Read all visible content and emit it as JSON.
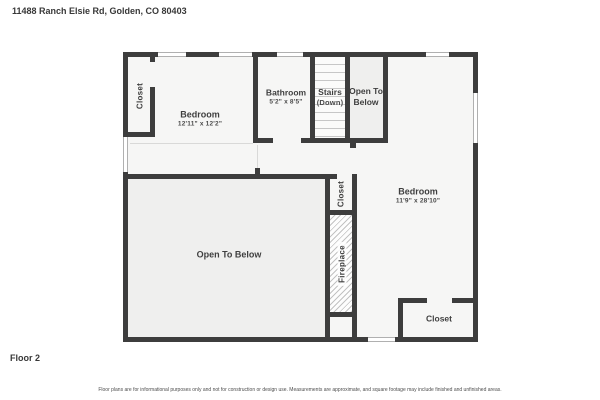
{
  "header": {
    "title": "11488 Ranch Elsie Rd, Golden, CO 80403"
  },
  "plan": {
    "rooms": {
      "closet_upper_left": {
        "label": "Closet"
      },
      "bedroom_upper": {
        "label": "Bedroom",
        "dimensions": "12'11\" x 12'2\""
      },
      "bathroom": {
        "label": "Bathroom",
        "dimensions": "5'2\" x 8'5\""
      },
      "stairs": {
        "label": "Stairs",
        "sublabel": "(Down)"
      },
      "open_to_below_upper": {
        "label": "Open To Below"
      },
      "bedroom_right": {
        "label": "Bedroom",
        "dimensions": "11'9\" x 28'10\""
      },
      "open_to_below_main": {
        "label": "Open To Below"
      },
      "closet_middle": {
        "label": "Closet"
      },
      "fireplace": {
        "label": "Fireplace"
      },
      "closet_bottom_right": {
        "label": "Closet"
      }
    }
  },
  "footer": {
    "floor_label": "Floor 2",
    "disclaimer": "Floor plans are for informational purposes only and not for construction or design use. Measurements are approximate, and square footage may include finished and unfinished areas."
  },
  "colors": {
    "wall": "#3d3d3d",
    "room_fill": "#f6f6f5",
    "open_to_below_fill": "#efefee",
    "hatch_line": "#c2c2c2",
    "text": "#3f3f3f"
  }
}
